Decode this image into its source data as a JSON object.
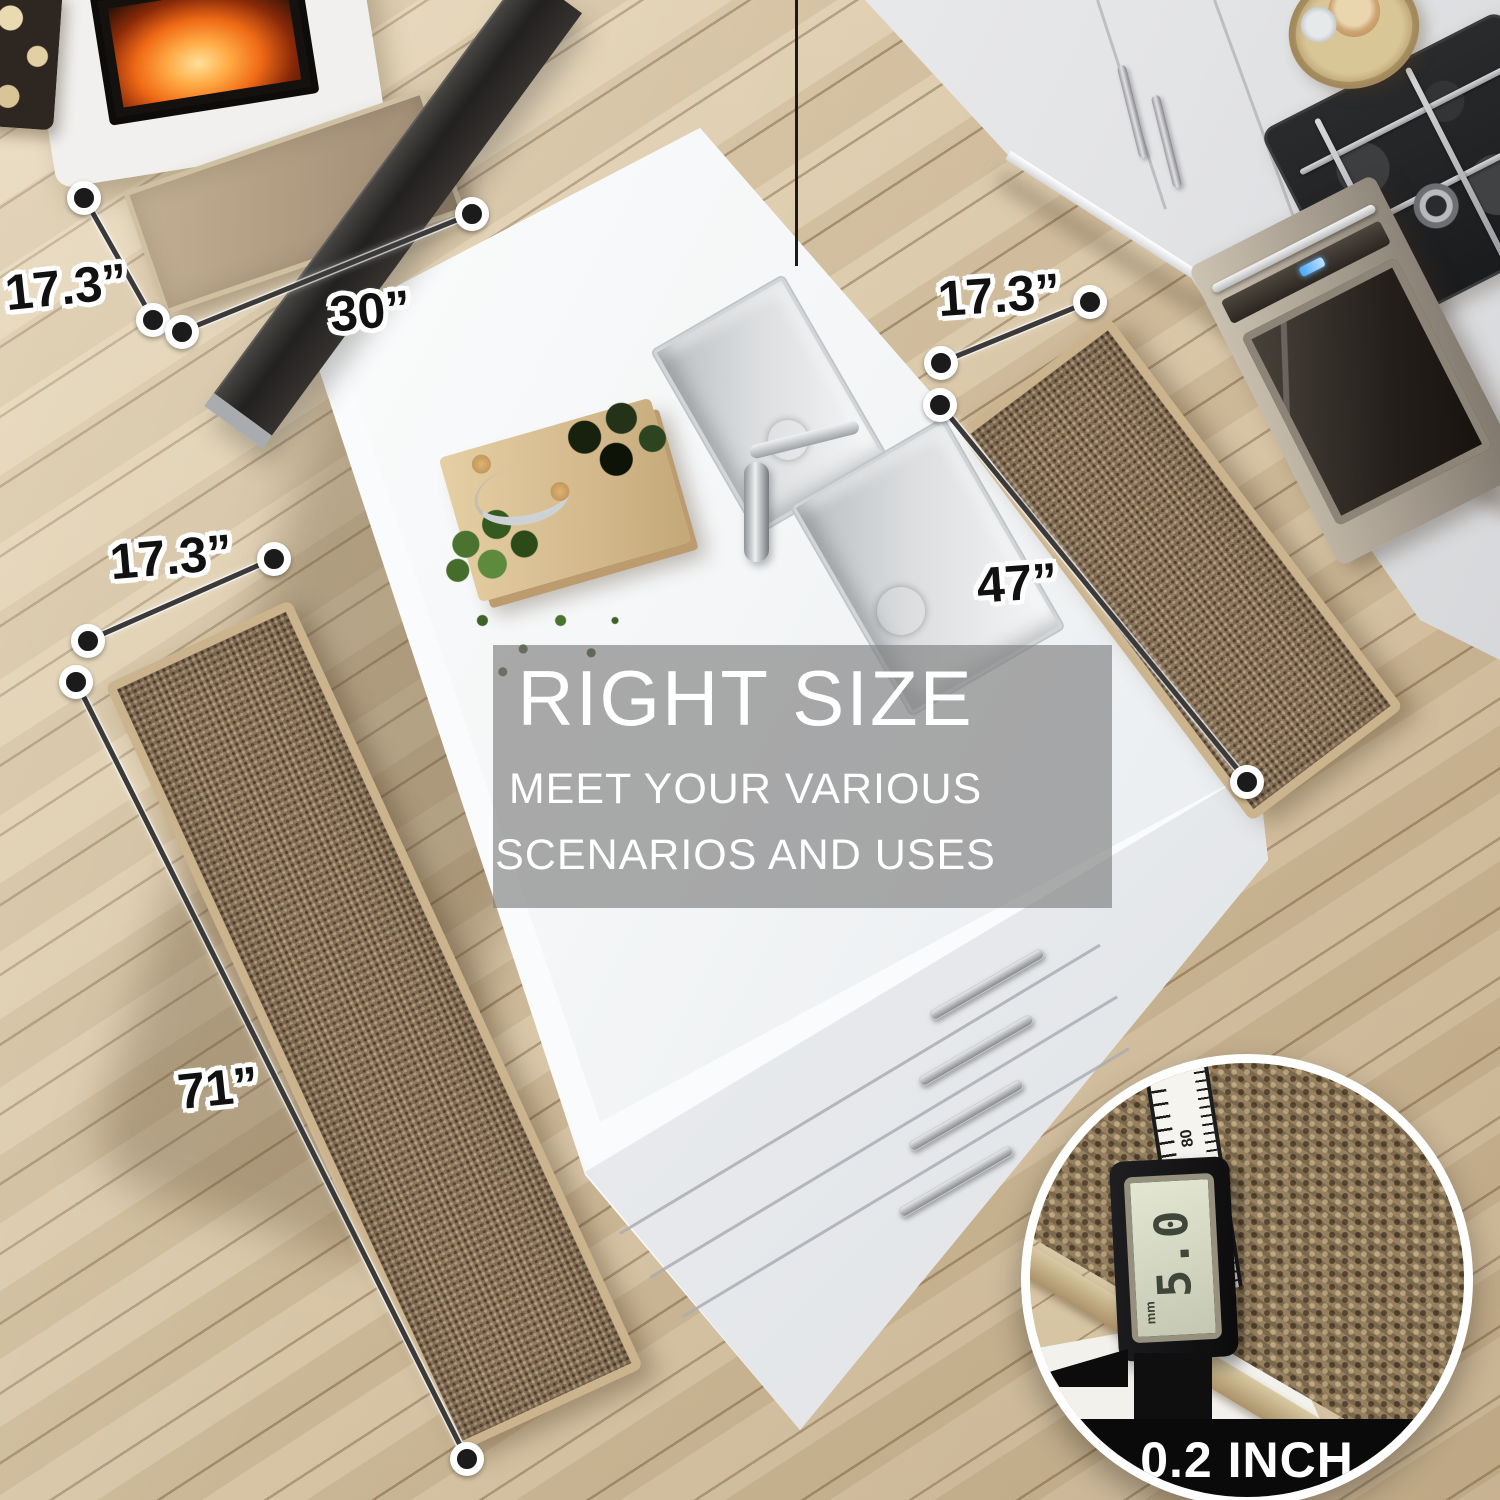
{
  "scene": {
    "dimension_labels": {
      "door_mat_width": "17.3”",
      "door_mat_length": "30”",
      "right_runner_width": "17.3”",
      "right_runner_length": "47”",
      "left_runner_width": "17.3”",
      "left_runner_length": "71”"
    },
    "overlay_banner": {
      "title": "RIGHT SIZE",
      "subtitle_line1": "MEET YOUR VARIOUS",
      "subtitle_line2": "SCENARIOS AND USES"
    },
    "detail_inset": {
      "caption": "0.2 INCH",
      "caliper_reading": "5.0",
      "caliper_unit": "mm",
      "ruler_ticks": [
        "90",
        "80",
        "70"
      ],
      "ruler_side_tick": "3"
    },
    "colors": {
      "floor": "#d8c5a5",
      "rug": "#8b7359",
      "rug_binding": "#cbb38d",
      "island_white": "#f5f6f8",
      "overlay_gray": "#808080",
      "dimension_line": "#3a3a3a",
      "caption_band": "#0a0a0a",
      "fire_orange": "#f06a16"
    }
  }
}
